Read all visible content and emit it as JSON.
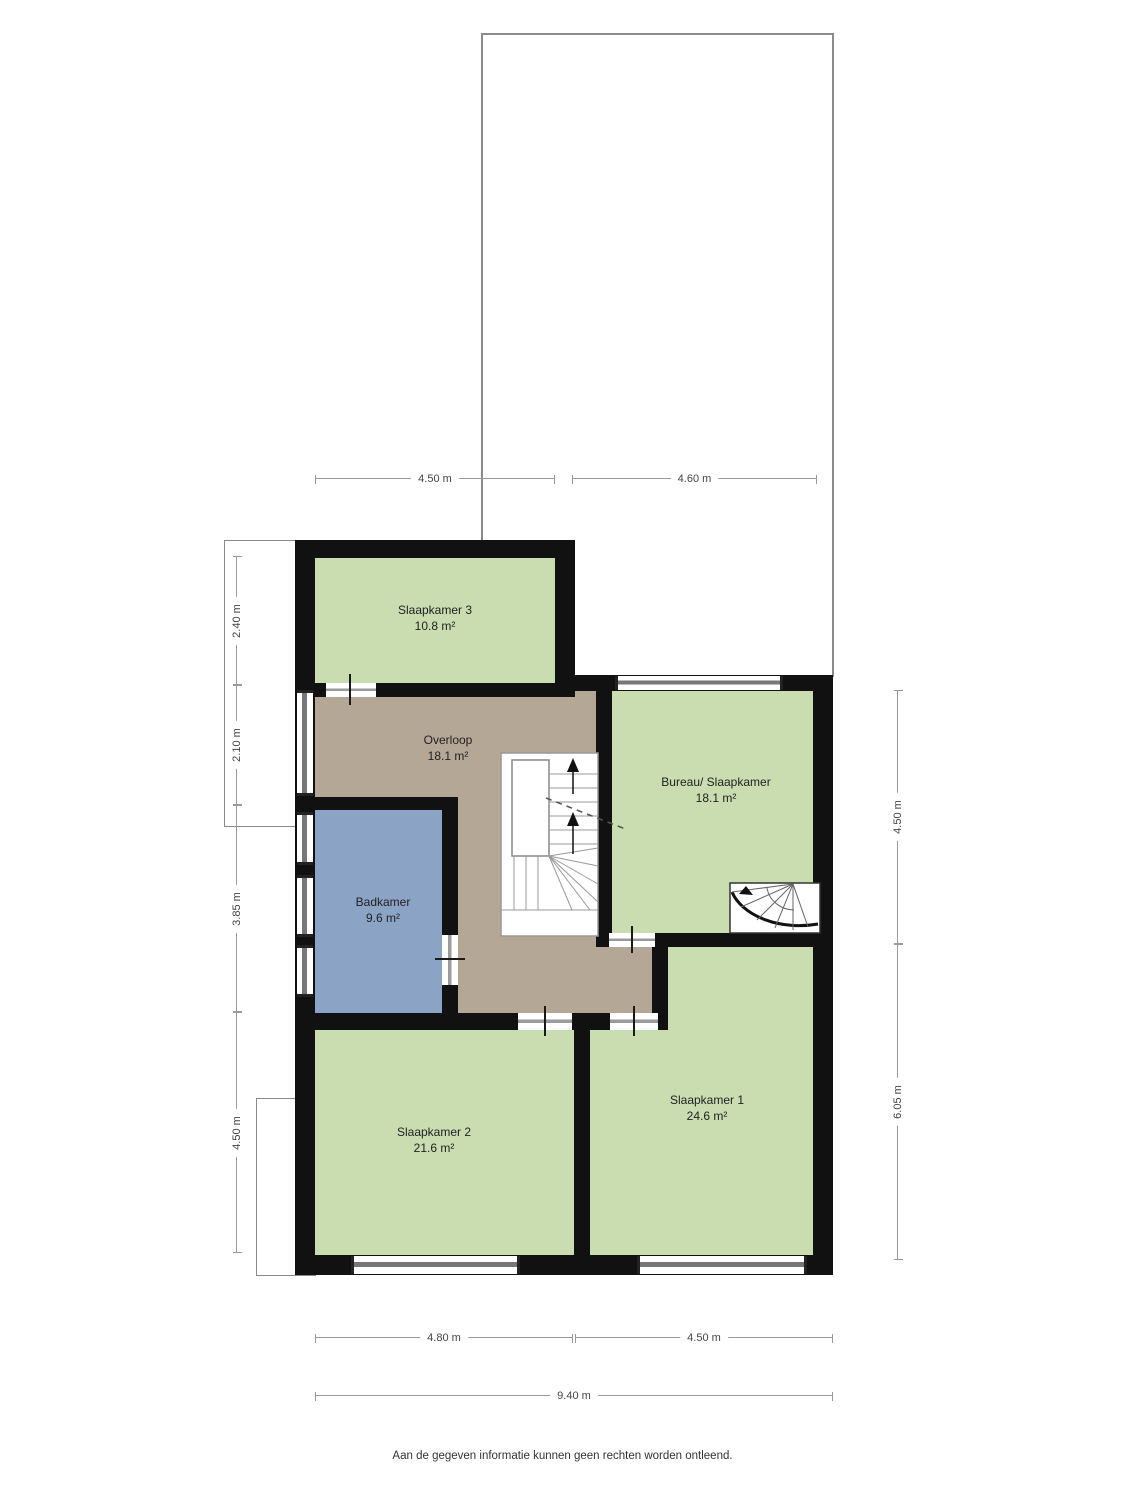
{
  "rooms": [
    {
      "id": "slaapkamer-3",
      "name": "Slaapkamer 3",
      "area": "10.8 m²"
    },
    {
      "id": "overloop",
      "name": "Overloop",
      "area": "18.1 m²"
    },
    {
      "id": "bureau-slaapkamer",
      "name": "Bureau/ Slaapkamer",
      "area": "18.1 m²"
    },
    {
      "id": "badkamer",
      "name": "Badkamer",
      "area": "9.6 m²"
    },
    {
      "id": "slaapkamer-2",
      "name": "Slaapkamer 2",
      "area": "21.6 m²"
    },
    {
      "id": "slaapkamer-1",
      "name": "Slaapkamer 1",
      "area": "24.6 m²"
    }
  ],
  "dimensions": {
    "top_left_width": "4.50 m",
    "top_right_width": "4.60 m",
    "left_slaapkamer3_depth": "2.40 m",
    "left_overloop_depth": "2.10 m",
    "left_badkamer_depth": "3.85 m",
    "left_slaapkamer2_depth": "4.50 m",
    "right_bureau_depth": "4.50 m",
    "right_slaapkamer1_depth": "6.05 m",
    "bottom_slaapkamer2_width": "4.80 m",
    "bottom_slaapkamer1_width": "4.50 m",
    "bottom_total_width": "9.40 m"
  },
  "footer": {
    "disclaimer": "Aan de gegeven informatie kunnen geen rechten worden ontleend."
  },
  "colors": {
    "room_green": "#c9ddb0",
    "hall_brown": "#b5a796",
    "bath_blue": "#8ba4c6",
    "wall_black": "#111111",
    "window_gray": "#777777",
    "dimension_gray": "#999999"
  }
}
